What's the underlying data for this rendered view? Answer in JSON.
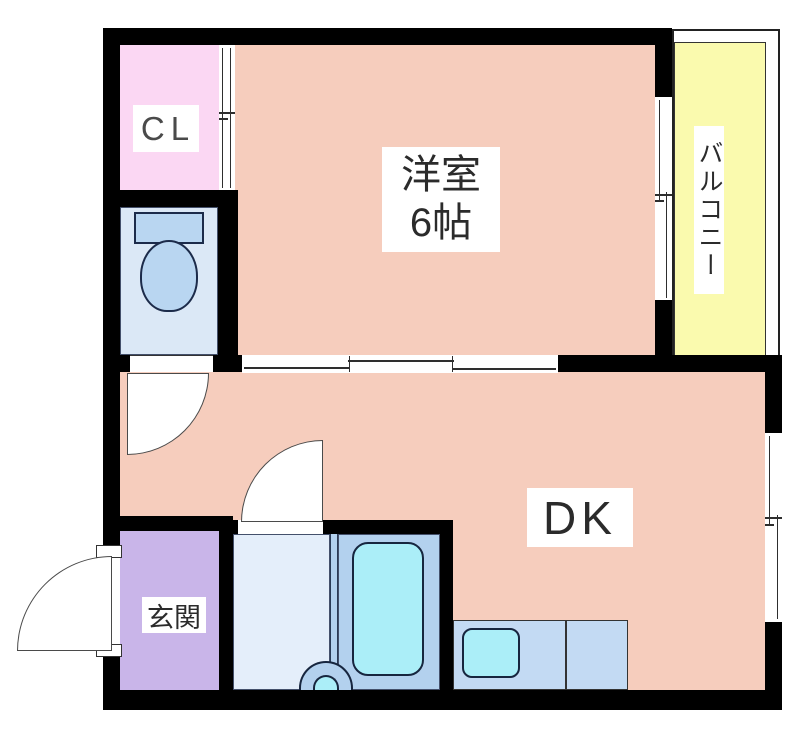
{
  "floorplan": {
    "title": "1DK apartment floor plan",
    "rooms": {
      "closet": {
        "label": "CL",
        "color": "#fbd7f3"
      },
      "western_room": {
        "label": "洋室",
        "size_label": "6帖",
        "color": "#f6cdbd"
      },
      "balcony": {
        "label": "バルコニー",
        "color": "#fafaae"
      },
      "dining_kitchen": {
        "label": "DK",
        "color": "#f6cdbd"
      },
      "entrance": {
        "label": "玄関",
        "color": "#c9b5e9"
      },
      "toilet_room": {
        "label": "",
        "color": "#dbe8f6"
      },
      "washroom": {
        "label": "",
        "color": "#e4eefa"
      },
      "bathroom": {
        "label": "",
        "color": "#b3d1ee"
      }
    },
    "fixtures": {
      "toilet": {
        "color": "#b9d6f1"
      },
      "bathtub": {
        "color": "#abeef8"
      },
      "washbasin": {
        "color": "#abeef8"
      },
      "kitchen_sink": {
        "color": "#abeef8"
      },
      "kitchen_counter": {
        "color": "#c3daf3"
      }
    },
    "colors": {
      "wall": "#000000",
      "fixture_outline": "#1c2b4a",
      "door_arc": "#4a4a4a",
      "text": "#2b2b2b",
      "background": "#ffffff"
    }
  }
}
